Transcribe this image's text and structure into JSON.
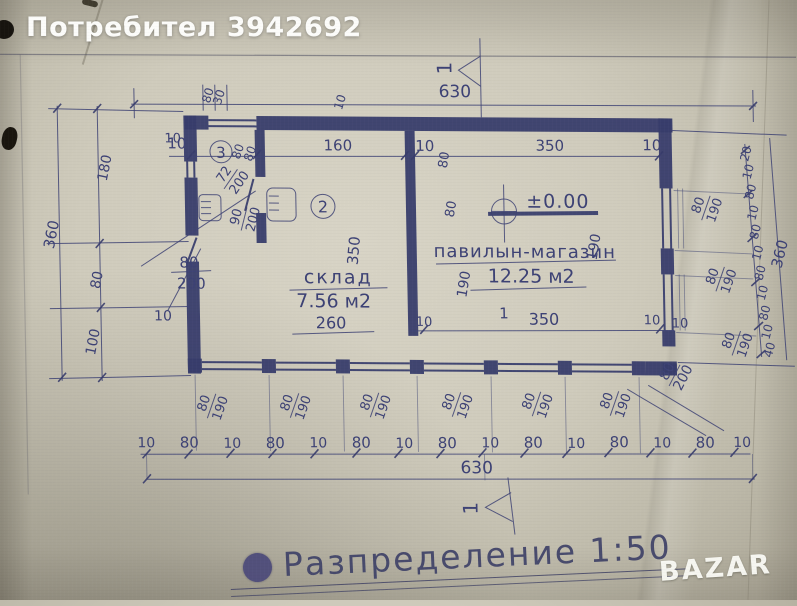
{
  "header": {
    "user": "Потребител 3942692"
  },
  "plan": {
    "level": "±0.00",
    "callout2": "2",
    "callout3": "3",
    "section_top": "1",
    "section_bottom": "1",
    "storage": {
      "name": "склад",
      "area": "7.56 м2",
      "width": "260",
      "depth": "350"
    },
    "shop": {
      "name": "павилын-магазин",
      "area": "12.25 м2",
      "width": "350",
      "number": "1",
      "gap_left": "10",
      "gap_right": "10",
      "vert_top": "80",
      "vert_mid": "80",
      "vert_low": "190",
      "vert_right": "190"
    },
    "doors": {
      "d1": {
        "w": "72",
        "h": "200"
      },
      "d2": {
        "w": "90",
        "h": "200"
      },
      "d3": {
        "w": "80",
        "h": "200"
      },
      "d4": {
        "w": "80",
        "h": "200"
      }
    },
    "dims": {
      "top_total": "630",
      "bottom_total": "630",
      "left_total": "360",
      "right_total": "360",
      "left_chain": [
        "180",
        "80",
        "100"
      ],
      "left_ten": "10",
      "left_ten2": "10",
      "right_ten": "10",
      "top_row": [
        "10",
        "160",
        "10",
        "350",
        "10"
      ],
      "top_row_rot": [
        "80",
        "80"
      ],
      "top_window": [
        "80",
        "30"
      ],
      "top_ten": "10",
      "bottom_chain": [
        "10",
        "80",
        "10",
        "80",
        "10",
        "80",
        "10",
        "80",
        "10",
        "80",
        "10",
        "80",
        "10",
        "80",
        "10"
      ],
      "window_w": "80",
      "window_h": "190",
      "right_chain": [
        "20",
        "10",
        "80",
        "10",
        "80",
        "10",
        "80",
        "10",
        "80",
        "10",
        "40"
      ]
    }
  },
  "footer": {
    "title": "Разпределение 1:50",
    "watermark": "BAZAR"
  }
}
